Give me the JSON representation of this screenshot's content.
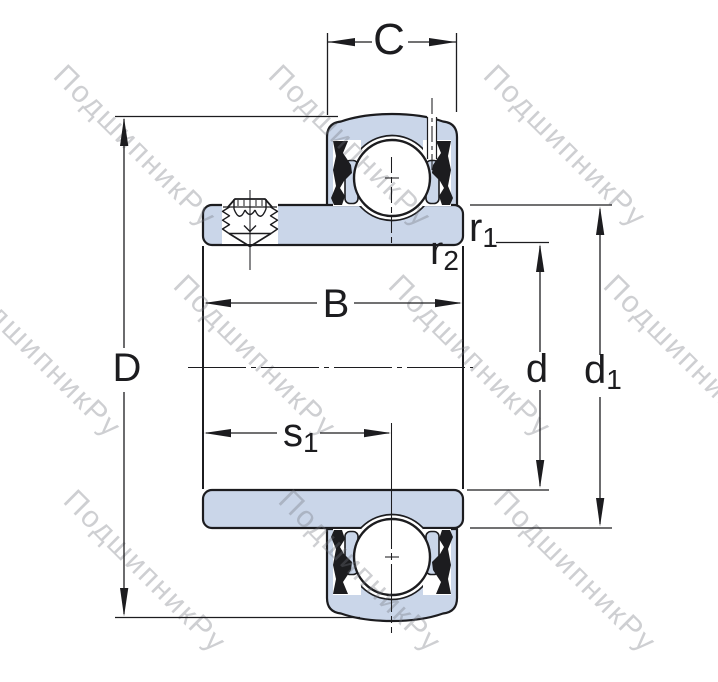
{
  "figure_alt": "Cross-section technical drawing of a sealed insert ball bearing (Y-bearing) with extended inner ring, set screw and dimension callouts",
  "watermark": {
    "text": "ПодшипникРу"
  },
  "labels": {
    "C": "C",
    "D": "D",
    "B": "B",
    "d": "d",
    "s1": {
      "base": "s",
      "sub": "1"
    },
    "d1": {
      "base": "d",
      "sub": "1"
    },
    "r1": {
      "base": "r",
      "sub": "1"
    },
    "r2": {
      "base": "r",
      "sub": "2"
    }
  },
  "colors": {
    "part_fill": "#cad6e9",
    "outline": "#1c1c1f",
    "dimension": "#1c1c1f",
    "watermark": "#70727a",
    "ball": "#ffffff",
    "background": "#ffffff"
  }
}
